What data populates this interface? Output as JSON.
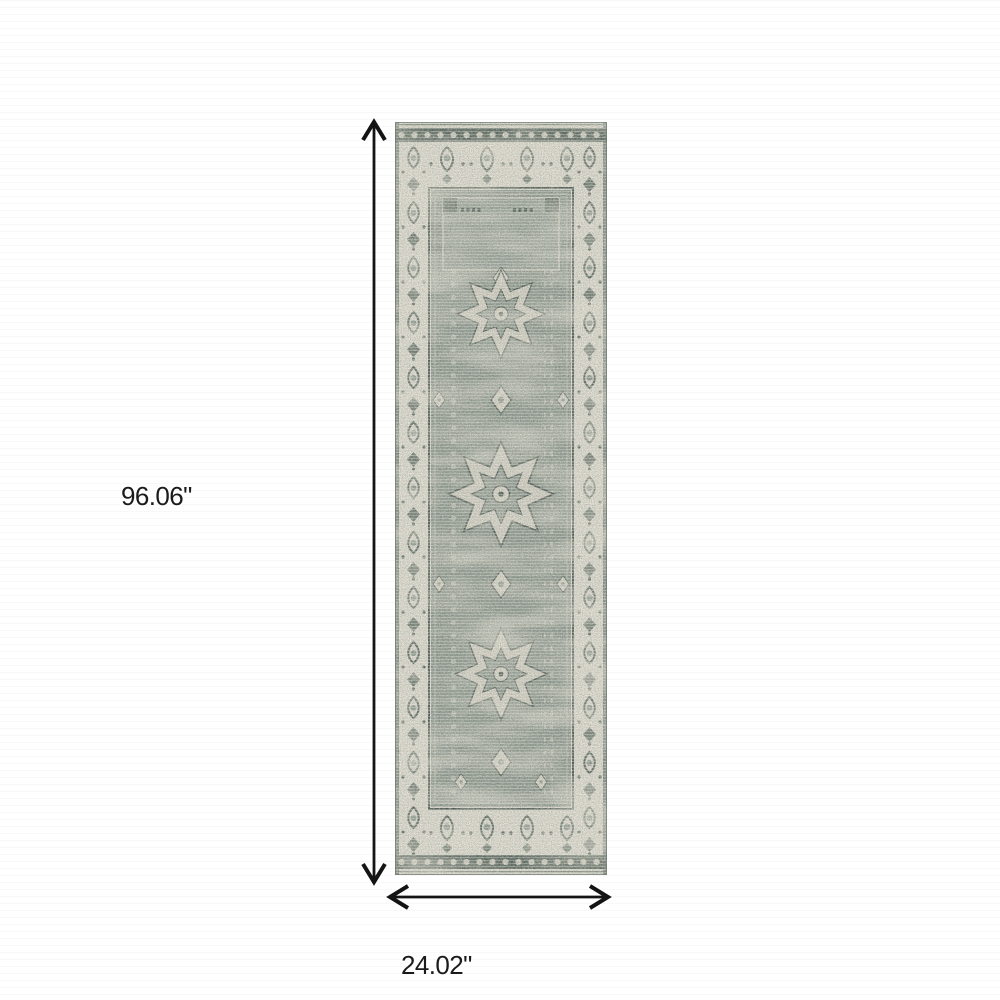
{
  "diagram": {
    "type": "product-dimension-diagram",
    "image_alt": "Distressed grey-green and ivory oriental runner rug shown flat with dimension arrows",
    "height": {
      "label": "96.06\""
    },
    "width": {
      "label": "24.02\""
    },
    "colors": {
      "arrow": "#141414",
      "label_text": "#1b1b1b"
    }
  },
  "rug": {
    "colors": {
      "field": "#909b92",
      "border": "#e4e0d5",
      "motif_dark": "#5d6b62",
      "outline_dark": "#49564f",
      "medallion_cream": "#dbd7ca",
      "band_dark": "#56645c"
    }
  }
}
